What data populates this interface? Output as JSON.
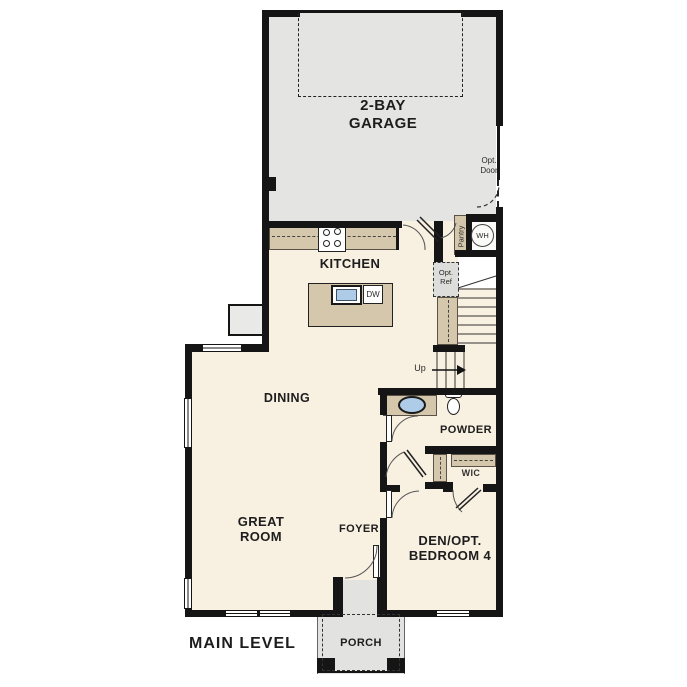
{
  "plan": {
    "level_label": "MAIN LEVEL",
    "rooms": {
      "garage_l1": "2-BAY",
      "garage_l2": "GARAGE",
      "kitchen": "KITCHEN",
      "dining": "DINING",
      "great_l1": "GREAT",
      "great_l2": "ROOM",
      "foyer": "FOYER",
      "powder": "POWDER",
      "wic": "WIC",
      "den_l1": "DEN/OPT.",
      "den_l2": "BEDROOM 4",
      "porch": "PORCH"
    },
    "annotations": {
      "opt_door_l1": "Opt.",
      "opt_door_l2": "Door",
      "opt_ref_l1": "Opt.",
      "opt_ref_l2": "Ref",
      "pantry": "Pantry",
      "water_heater": "WH",
      "dishwasher": "DW",
      "stairs_up": "Up"
    },
    "colors": {
      "floor": "#f8f0e1",
      "garage_floor": "#e4e4e2",
      "porch_floor": "#e2e2e0",
      "cabinet_tan": "#d5c7ab",
      "sink_blue": "#aecce8",
      "wall": "#151515",
      "text": "#1d1d1d"
    }
  }
}
